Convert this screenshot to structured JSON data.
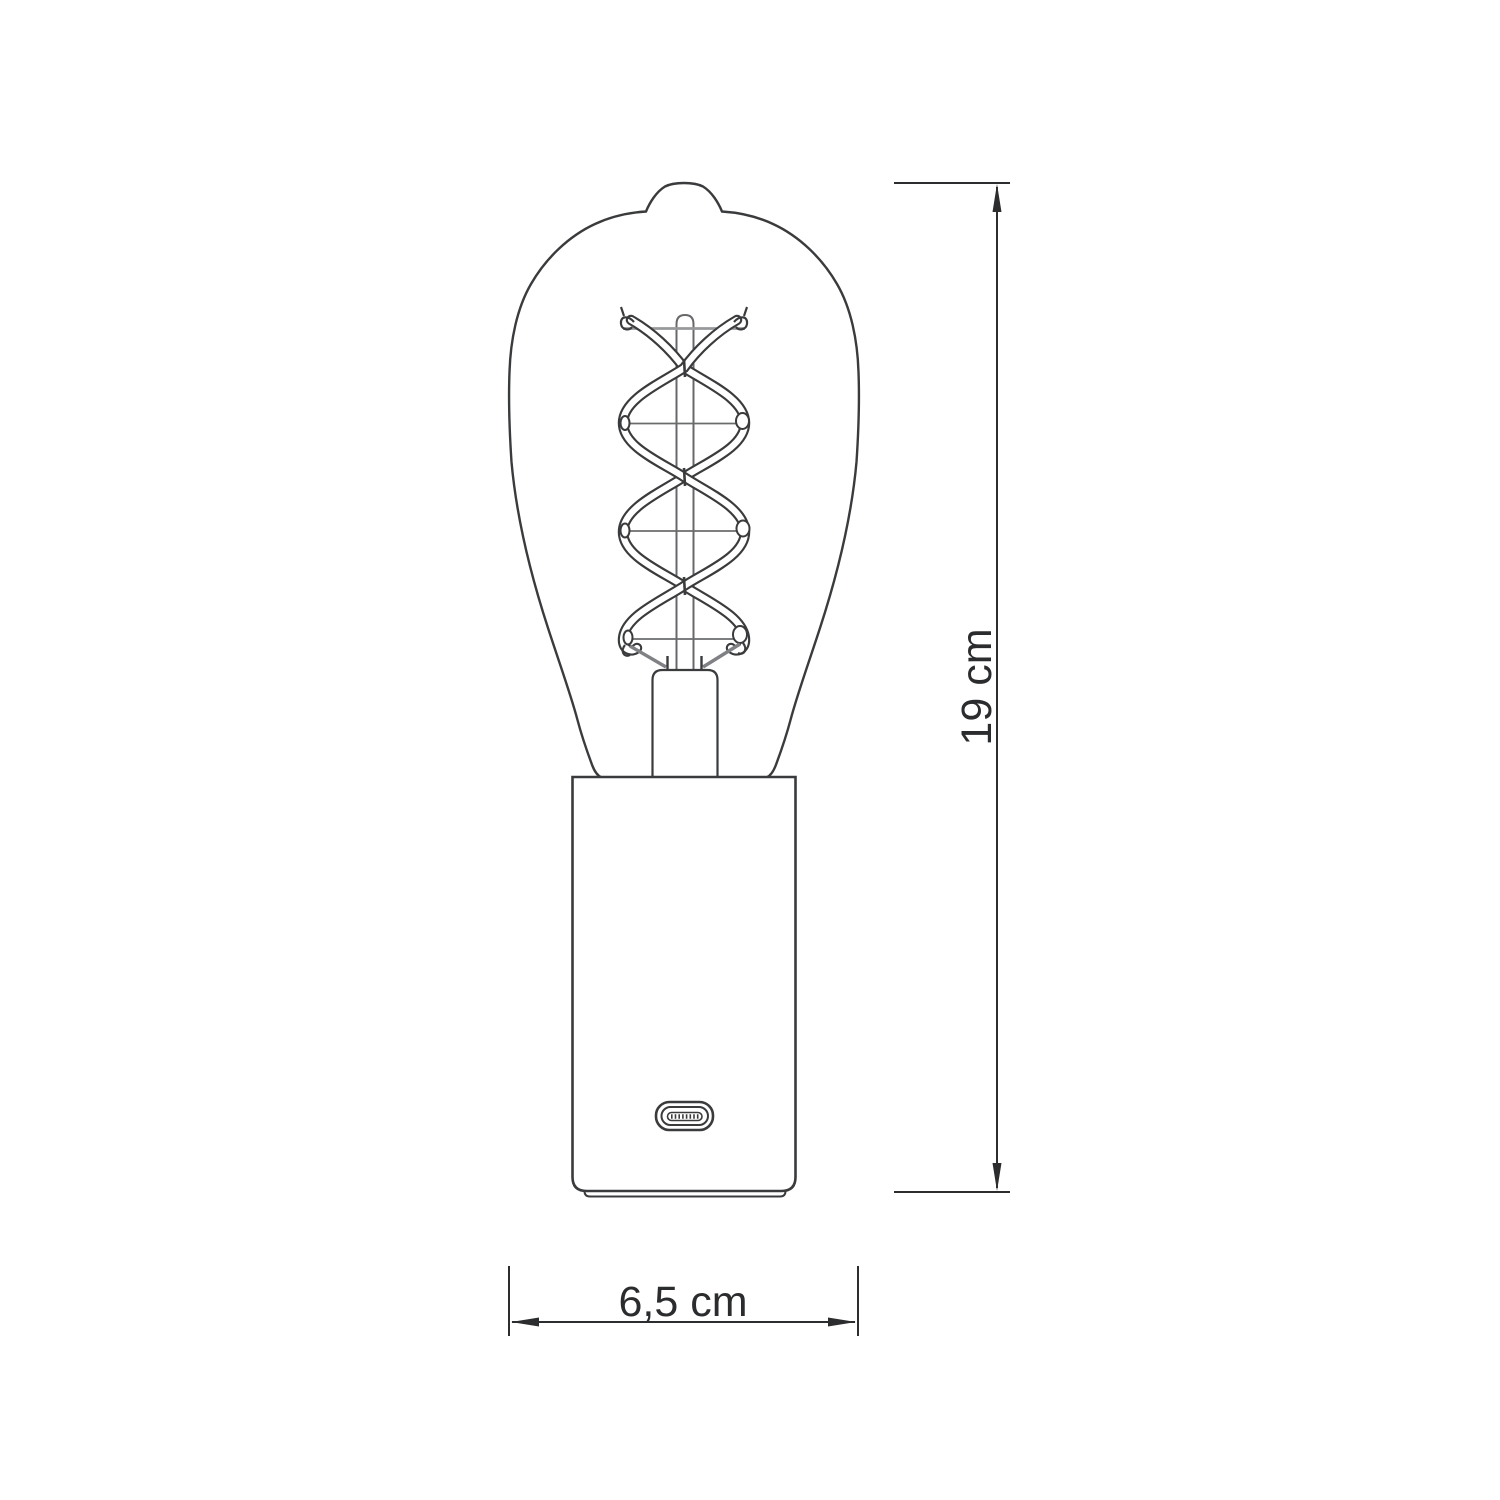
{
  "diagram": {
    "labels": {
      "height": "19 cm",
      "width": "6,5 cm"
    }
  },
  "colors": {
    "background": "#ffffff",
    "drawing_stroke": "#3a3b3d",
    "dimension_stroke": "#2c2d2f",
    "support_wire_gray": "#97999b",
    "stem_gray": "#66686b",
    "lead_wire_gray": "#7f8184",
    "label_text": "#2b2c2e"
  }
}
